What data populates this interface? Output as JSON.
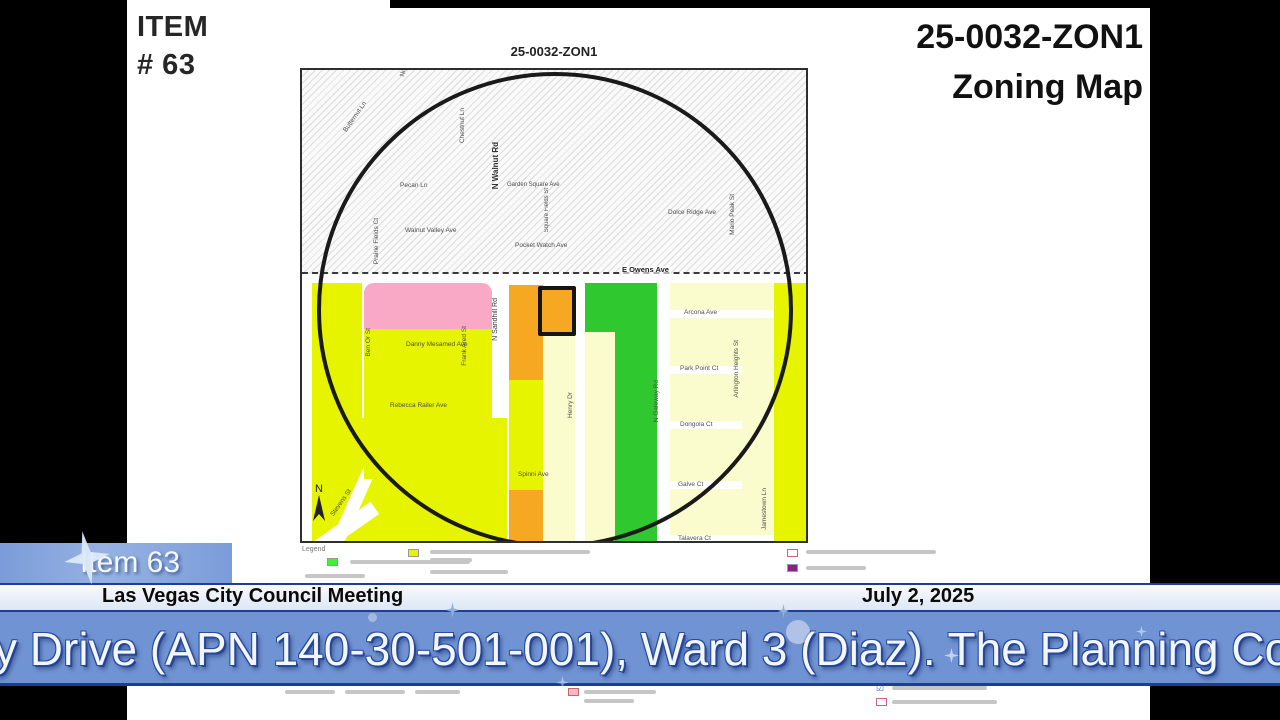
{
  "header": {
    "item_line1": "ITEM",
    "item_line2": "# 63",
    "case_line1": "25-0032-ZON1",
    "case_line2": "Zoning Map"
  },
  "map": {
    "title": "25-0032-ZON1",
    "north": "N",
    "streets": {
      "butternut": "Butternut Ln",
      "nutmeg": "Nutmeg Ln",
      "chestnut": "Chestnut Ln",
      "n_walnut": "N Walnut Rd",
      "pecan": "Pecan Ln",
      "garden_square": "Garden Square Ave",
      "square_fields": "Square Fields St",
      "walnut_valley": "Walnut Valley Ave",
      "prairie_fields": "Prairie Fields Ct",
      "pocket_watch": "Pocket Watch Ave",
      "dolce_ridge": "Dolce Ridge Ave",
      "mario_peak": "Mario Peak St",
      "e_owens": "E Owens Ave",
      "n_sandhill": "N Sandhill Rd",
      "danny_mesamed": "Danny Mesamed Ave",
      "ben_or": "Ben Or St",
      "frank_ared": "Frank Ared St",
      "rebecca_railer": "Rebecca Railer Ave",
      "henry": "Henry Dr",
      "n_gateway": "N Gateway Rd",
      "arcona": "Arcona Ave",
      "park_point": "Park Point Ct",
      "arlington_heights": "Arlington Heights St",
      "dongola": "Dongola Ct",
      "galve": "Galve Ct",
      "talavera": "Talavera Ct",
      "jamestown": "Jamestown Ln",
      "spinni": "Spinni Ave",
      "stevens": "Stevens St"
    },
    "zone_colors": {
      "chartreuse": "#e6f400",
      "pale_yellow": "#fbfccd",
      "orange": "#f7a823",
      "pink": "#f9a9c5",
      "green": "#2fc82f"
    }
  },
  "legend": {
    "label": "Legend"
  },
  "overlay": {
    "item_badge": "Item 63",
    "meeting_title": "Las Vegas City Council Meeting",
    "meeting_date": "July 2, 2025",
    "ticker_text": "y Drive (APN 140-30-501-001), Ward 3 (Diaz). The Planning Cor",
    "banner_blue": "#7093d3",
    "banner_border_blue": "#1d3e94"
  }
}
